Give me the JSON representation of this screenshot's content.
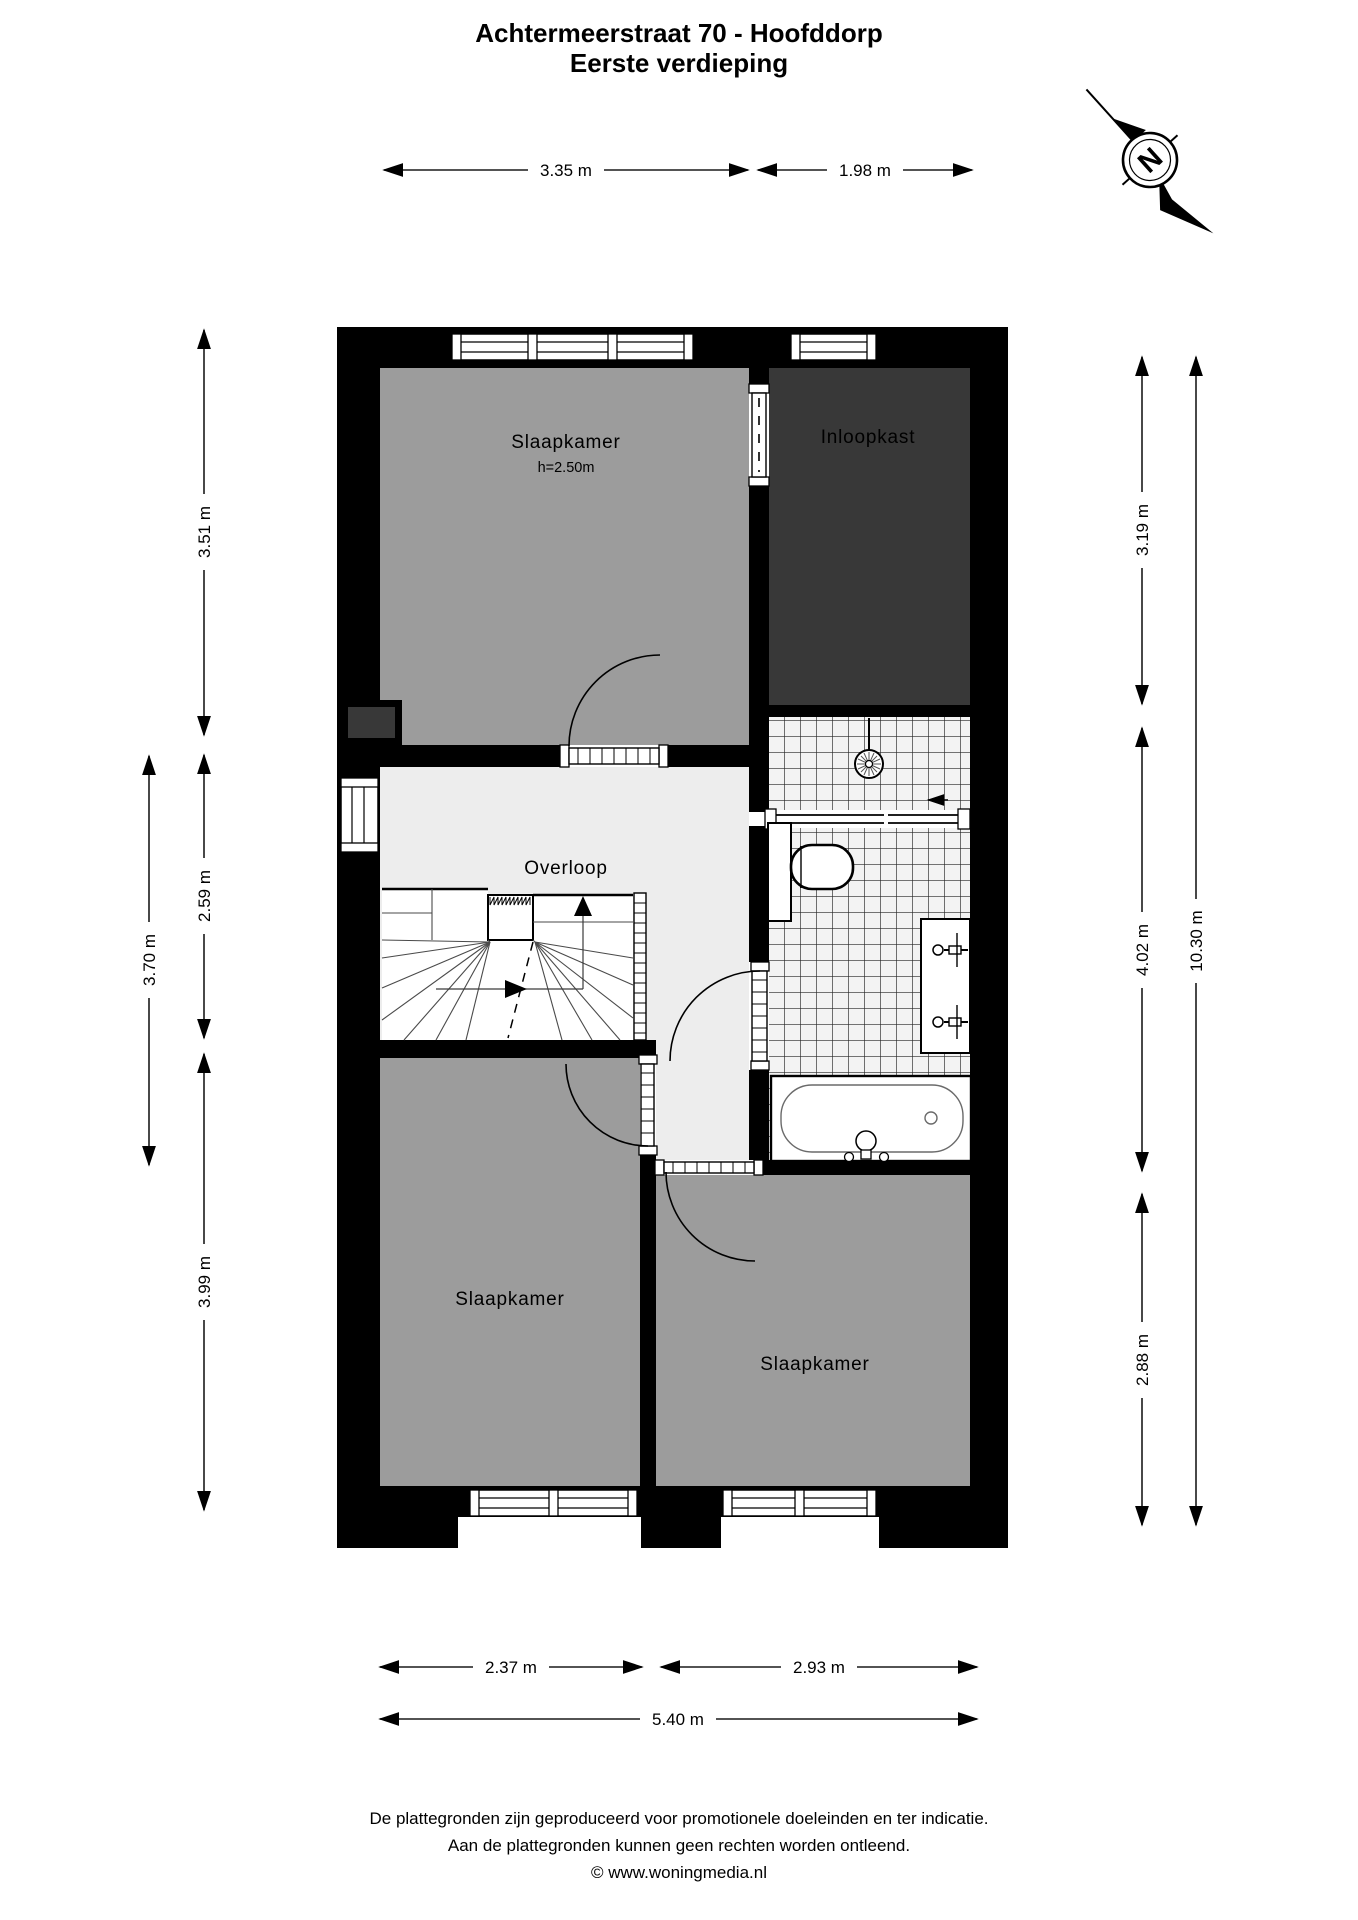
{
  "title": {
    "line1": "Achtermeerstraat 70 - Hoofddorp",
    "line2": "Eerste verdieping"
  },
  "compass": {
    "label": "N"
  },
  "rooms": {
    "bedroom_top": {
      "label": "Slaapkamer",
      "ceiling": "h=2.50m"
    },
    "closet": {
      "label": "Inloopkast"
    },
    "landing": {
      "label": "Overloop"
    },
    "bedroom_bottom_left": {
      "label": "Slaapkamer"
    },
    "bedroom_bottom_right": {
      "label": "Slaapkamer"
    }
  },
  "dimensions": {
    "top_left": "3.35 m",
    "top_right": "1.98 m",
    "left_upper": "3.51 m",
    "left_middle": "2.59 m",
    "left_lower": "3.99 m",
    "left_outer": "3.70 m",
    "right_upper": "3.19 m",
    "right_middle": "4.02 m",
    "right_lower": "2.88 m",
    "right_outer": "10.30 m",
    "bottom_left": "2.37 m",
    "bottom_right": "2.93 m",
    "bottom_total": "5.40 m"
  },
  "footer": {
    "line1": "De plattegronden zijn geproduceerd voor promotionele doeleinden en ter indicatie.",
    "line2": "Aan de plattegronden kunnen geen rechten worden ontleend.",
    "line3": "© www.woningmedia.nl"
  },
  "colors": {
    "wall": "#000000",
    "bedroom": "#9c9c9c",
    "closet": "#383838",
    "landing": "#ededed",
    "tile": "#f3f3f3",
    "page": "#ffffff"
  }
}
